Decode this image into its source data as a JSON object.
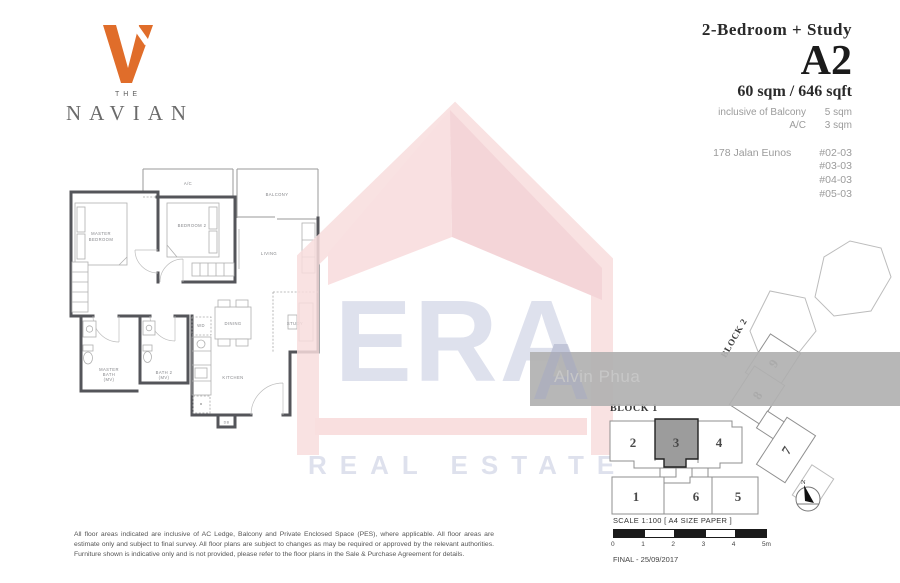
{
  "logo": {
    "the": "THE",
    "name": "NAVIAN"
  },
  "header": {
    "unit_type": "2-Bedroom + Study",
    "unit_code": "A2",
    "area": "60 sqm / 646 sqft",
    "inclusive": [
      {
        "label": "inclusive of Balcony",
        "value": "5 sqm"
      },
      {
        "label": "A/C",
        "value": "3 sqm"
      }
    ],
    "address": "178 Jalan Eunos",
    "stack_units": [
      "#02-03",
      "#03-03",
      "#04-03",
      "#05-03"
    ]
  },
  "floorplan": {
    "rooms": {
      "ac": "A/C",
      "balcony": "BALCONY",
      "master1": "MASTER",
      "master2": "BEDROOM",
      "bedroom2": "BEDROOM 2",
      "living": "LIVING",
      "study": "STUDY",
      "dining": "DINING",
      "kitchen": "KITCHEN",
      "mbath1": "MASTER",
      "mbath2": "BATH",
      "mbath3": "(MV)",
      "bath2a": "BATH 2",
      "bath2b": "(MV)",
      "wd": "WD",
      "db": "DB"
    }
  },
  "watermark": {
    "era": "ERA",
    "real_estate": "REAL ESTATE",
    "agent": "Alvin Phua",
    "initial": "A"
  },
  "siteplan": {
    "block1": "BLOCK 1",
    "block2": "BLOCK 2",
    "north": "N",
    "units": {
      "u1": "1",
      "u2": "2",
      "u3": "3",
      "u4": "4",
      "u5": "5",
      "u6": "6",
      "u7": "7",
      "u8": "8",
      "u9": "9"
    },
    "highlighted_unit": "3"
  },
  "footer": {
    "scale": "SCALE 1:100 [ A4 SIZE PAPER ]",
    "ticks": [
      "0",
      "1",
      "2",
      "3",
      "4",
      "5m"
    ],
    "final": "FINAL - 25/09/2017",
    "disclaimer": "All floor areas indicated are inclusive of AC Ledge, Balcony and Private Enclosed Space (PES), where applicable. All floor areas are estimate only and subject to final survey. All floor plans are subject to changes as may be required or approved by the relevant authorities. Furniture shown is indicative only and is not provided, please refer to the floor plans in the Sale & Purchase Agreement for details."
  },
  "colors": {
    "accent_orange": "#e06d2a",
    "watermark_pink": "#f8dada",
    "watermark_blue": "#d9dcea",
    "highlight_gray": "#9c9c9c"
  }
}
